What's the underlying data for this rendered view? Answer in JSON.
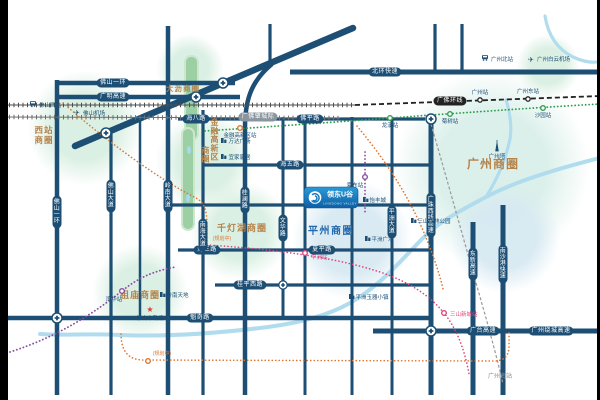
{
  "logo": {
    "name": "领东U谷",
    "tagline": "LINGDONG VALLEY"
  },
  "districts": {
    "xizhan_l1": "西站",
    "xizhan_l2": "商圈",
    "dali": "大沥商圈",
    "guangzhou": "广州商圈",
    "qiandenghu": "千灯湖商圈",
    "zumiao": "祖庙商圈",
    "pingzhou": "平州商圈",
    "jinrong": "金融高新区",
    "jinrong_suffix": "商圈"
  },
  "roads": {
    "foshan_ring_h": "佛山一环",
    "guangming_expwy": "广明高速",
    "beihuan_expwy": "北环快速",
    "haiba_rd": "海八路",
    "foping_rd": "佛平路",
    "haiwu_rd": "海五路",
    "haisan_rd": "海三路",
    "xiaping_rd": "夏平路",
    "guipingxi_rd": "桂平西路",
    "kuiqi_rd": "魁奇路",
    "guangtai_expwy": "广台高速",
    "raocheng_expwy": "广州绕城高速",
    "foshan_ring_v": "佛山一环",
    "foshan_ave": "佛山大道",
    "lingnan_ave": "岭南大道",
    "nanhai_ave": "南海大道",
    "guilan_rd": "桂澜路",
    "wenhua_rd": "文华路",
    "pingzhou_ave": "平洲大道",
    "guangzhuxi_expwy": "广珠西线高速",
    "dongxin_expwy": "东新高速",
    "nanshagang_expwy": "南沙港快速"
  },
  "railways": {
    "guangfozhao": "广佛肇城际",
    "guangfohuan": "广佛环线",
    "south_station": "广州南站"
  },
  "stations": {
    "foshan_west": "佛山西站",
    "guangzhou_north": "广州北站",
    "guangzhou_stn": "广州站",
    "guangzhou_east": "广州东站",
    "jinrong_stn": "金融高新区站",
    "longxi": "龙溪站",
    "jushu": "菊树站",
    "shayuan": "沙园站",
    "wanhua": "湾华站",
    "xiadong": "夏东站",
    "pingzhou_stn": "平洲站",
    "sanshan": "三山新城站",
    "planned": "(规划中)"
  },
  "airports": {
    "foshan": "佛山机场",
    "baiyun": "广州白云机场"
  },
  "pois": {
    "gz_tower": "广州塔",
    "wanda": "万达广场",
    "ikea": "宜家家居",
    "lingnan_tiandi": "岭南天地",
    "gov": "佛山市政府",
    "jade_town": "平洲玉器小镇",
    "yifeng": "怡丰城",
    "pingzhou_sq": "平洲广场",
    "sanshan_park": "三山森林公园"
  }
}
